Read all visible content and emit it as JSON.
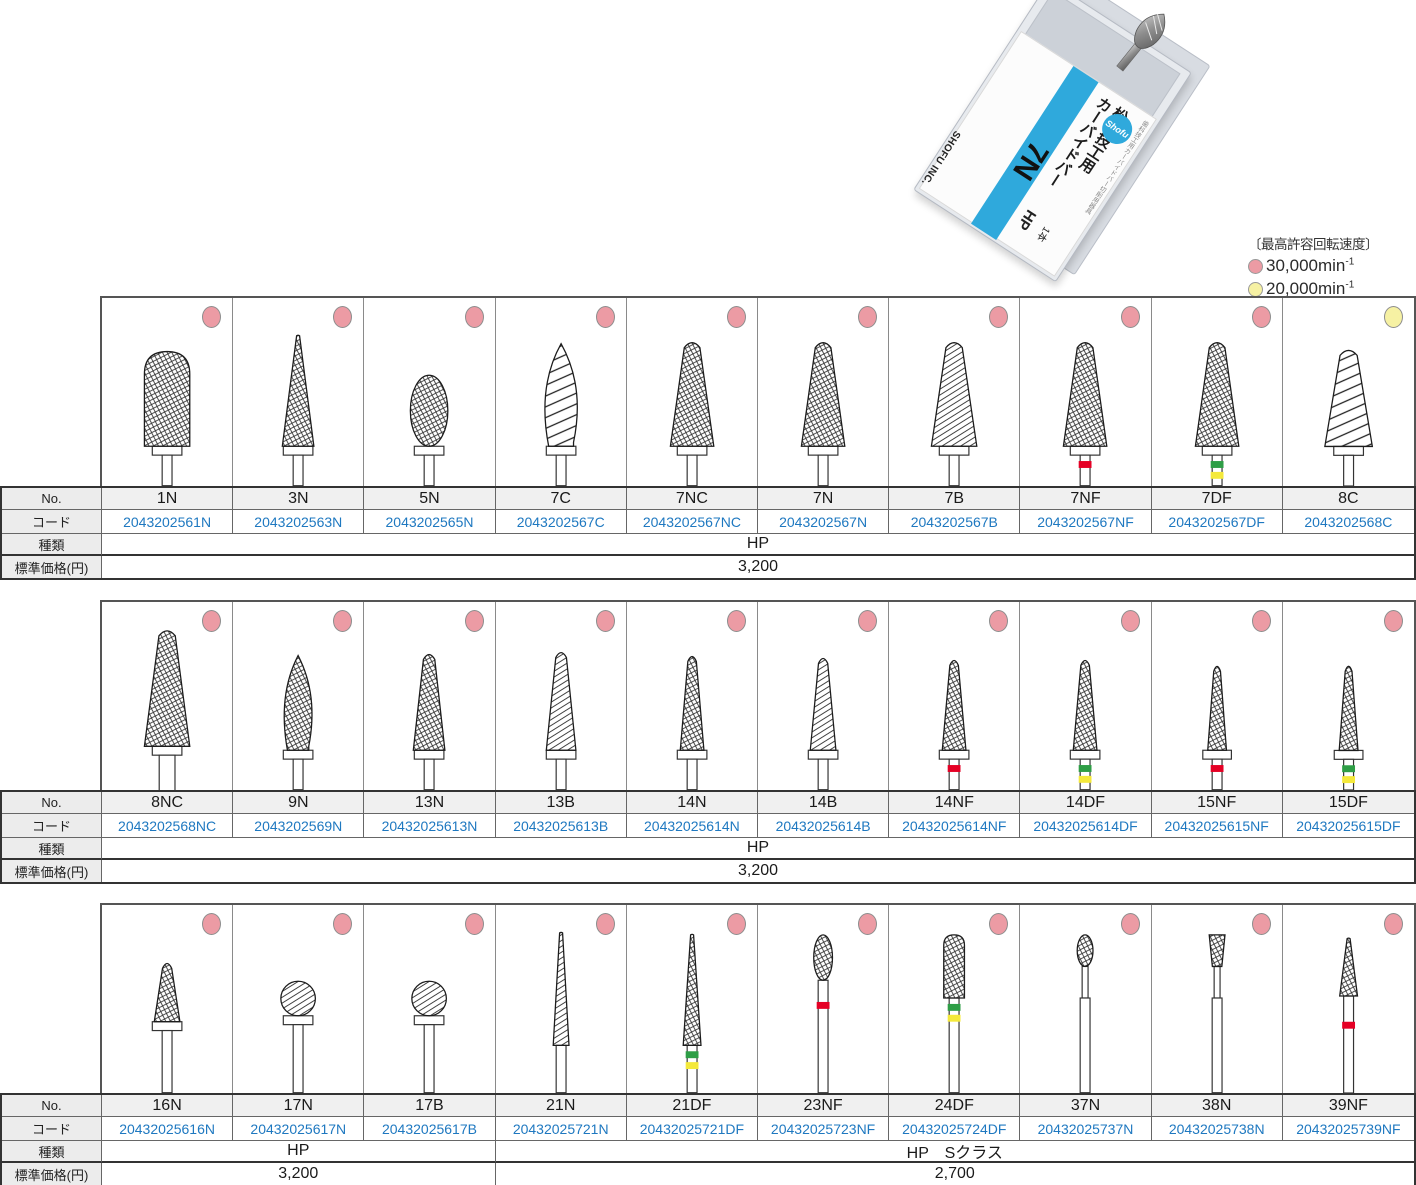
{
  "package": {
    "tiny_label": "歯科技工用カーバイドバー切削用器具",
    "title_line1": "松風技工用",
    "title_line2": "カーバイドバー",
    "size": "7N",
    "type": "HP",
    "qty": "1本",
    "brand": "SHOFU INC.",
    "logo": "Shofu"
  },
  "legend": {
    "title": "〔最高許容回転速度〕",
    "items": [
      {
        "color": "#EC9BA4",
        "label": "30,000min",
        "sup": "-1"
      },
      {
        "color": "#F6F1A3",
        "label": "20,000min",
        "sup": "-1"
      }
    ]
  },
  "row_labels": {
    "no": "No.",
    "code": "コード",
    "type": "種類",
    "price": "標準価格(円)"
  },
  "colors": {
    "dot_pink": "#EC9BA4",
    "dot_yellow": "#F6F1A3",
    "band_red": "#E50025",
    "band_green": "#2E9E46",
    "band_yellow": "#F4E93B",
    "code_blue": "#1E78C0",
    "shofu_blue": "#2FA9DC"
  },
  "tables": [
    {
      "products": [
        {
          "no": "1N",
          "code": "2043202561N",
          "dot": "pink",
          "shape": "barrel",
          "bands": []
        },
        {
          "no": "3N",
          "code": "2043202563N",
          "dot": "pink",
          "shape": "cone_tall",
          "bands": []
        },
        {
          "no": "5N",
          "code": "2043202565N",
          "dot": "pink",
          "shape": "bud",
          "bands": []
        },
        {
          "no": "7C",
          "code": "2043202567C",
          "dot": "pink",
          "shape": "flame",
          "bands": []
        },
        {
          "no": "7NC",
          "code": "2043202567NC",
          "dot": "pink",
          "shape": "taper_round",
          "bands": []
        },
        {
          "no": "7N",
          "code": "2043202567N",
          "dot": "pink",
          "shape": "taper_round",
          "bands": []
        },
        {
          "no": "7B",
          "code": "2043202567B",
          "dot": "pink",
          "shape": "taper_plain",
          "bands": []
        },
        {
          "no": "7NF",
          "code": "2043202567NF",
          "dot": "pink",
          "shape": "taper_round",
          "bands": [
            "red"
          ]
        },
        {
          "no": "7DF",
          "code": "2043202567DF",
          "dot": "pink",
          "shape": "taper_round",
          "bands": [
            "green",
            "yellow"
          ]
        },
        {
          "no": "8C",
          "code": "2043202568C",
          "dot": "yellow",
          "shape": "cone_coarse",
          "bands": []
        }
      ],
      "type_spans": [
        {
          "cols": 10,
          "label": "HP"
        }
      ],
      "price_spans": [
        {
          "cols": 10,
          "label": "3,200"
        }
      ]
    },
    {
      "products": [
        {
          "no": "8NC",
          "code": "2043202568NC",
          "dot": "pink",
          "shape": "taper_large",
          "bands": []
        },
        {
          "no": "9N",
          "code": "2043202569N",
          "dot": "pink",
          "shape": "bud_point",
          "bands": []
        },
        {
          "no": "13N",
          "code": "20432025613N",
          "dot": "pink",
          "shape": "taper_slim",
          "bands": []
        },
        {
          "no": "13B",
          "code": "20432025613B",
          "dot": "pink",
          "shape": "taper_slim_p",
          "bands": []
        },
        {
          "no": "14N",
          "code": "20432025614N",
          "dot": "pink",
          "shape": "taper_slim2",
          "bands": []
        },
        {
          "no": "14B",
          "code": "20432025614B",
          "dot": "pink",
          "shape": "taper_slim2p",
          "bands": []
        },
        {
          "no": "14NF",
          "code": "20432025614NF",
          "dot": "pink",
          "shape": "taper_xslim",
          "bands": [
            "red"
          ]
        },
        {
          "no": "14DF",
          "code": "20432025614DF",
          "dot": "pink",
          "shape": "taper_xslim",
          "bands": [
            "green",
            "yellow"
          ]
        },
        {
          "no": "15NF",
          "code": "20432025615NF",
          "dot": "pink",
          "shape": "needle",
          "bands": [
            "red"
          ]
        },
        {
          "no": "15DF",
          "code": "20432025615DF",
          "dot": "pink",
          "shape": "needle",
          "bands": [
            "green",
            "yellow"
          ]
        }
      ],
      "type_spans": [
        {
          "cols": 10,
          "label": "HP"
        }
      ],
      "price_spans": [
        {
          "cols": 10,
          "label": "3,200"
        }
      ]
    },
    {
      "products": [
        {
          "no": "16N",
          "code": "20432025616N",
          "dot": "pink",
          "shape": "bud_tiny",
          "bands": []
        },
        {
          "no": "17N",
          "code": "20432025617N",
          "dot": "pink",
          "shape": "ball",
          "bands": []
        },
        {
          "no": "17B",
          "code": "20432025617B",
          "dot": "pink",
          "shape": "ball",
          "bands": []
        },
        {
          "no": "21N",
          "code": "20432025721N",
          "dot": "pink",
          "shape": "needle_long",
          "bands": []
        },
        {
          "no": "21DF",
          "code": "20432025721DF",
          "dot": "pink",
          "shape": "needle_long2",
          "bands": [
            "green",
            "yellow"
          ]
        },
        {
          "no": "23NF",
          "code": "20432025723NF",
          "dot": "pink",
          "shape": "pear_tiny",
          "bands": [
            "red"
          ]
        },
        {
          "no": "24DF",
          "code": "20432025724DF",
          "dot": "pink",
          "shape": "cyl_round",
          "bands": [
            "green",
            "yellow"
          ]
        },
        {
          "no": "37N",
          "code": "20432025737N",
          "dot": "pink",
          "shape": "pear_neck",
          "bands": []
        },
        {
          "no": "38N",
          "code": "20432025738N",
          "dot": "pink",
          "shape": "inv_cone",
          "bands": []
        },
        {
          "no": "39NF",
          "code": "20432025739NF",
          "dot": "pink",
          "shape": "taper_short",
          "bands": [
            "red"
          ]
        }
      ],
      "type_spans": [
        {
          "cols": 3,
          "label": "HP"
        },
        {
          "cols": 7,
          "label": "HP　Sクラス"
        }
      ],
      "price_spans": [
        {
          "cols": 3,
          "label": "3,200"
        },
        {
          "cols": 7,
          "label": "2,700"
        }
      ]
    }
  ]
}
